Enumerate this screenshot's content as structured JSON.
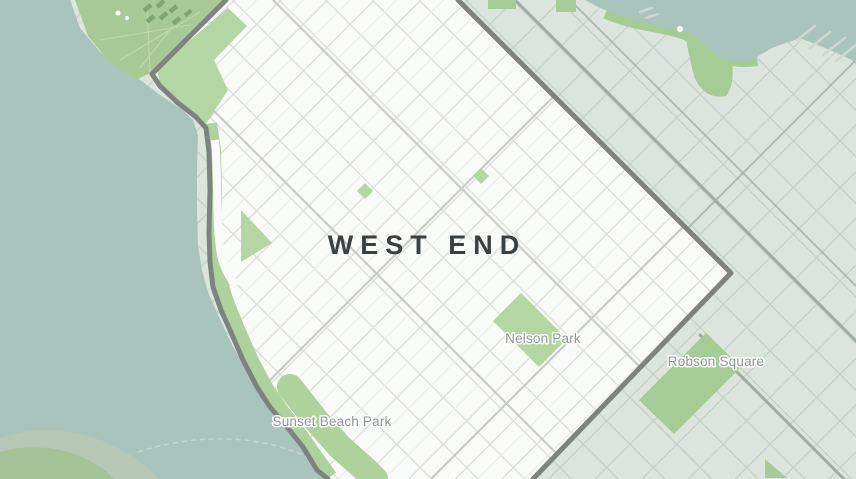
{
  "map": {
    "region_label": "WEST END",
    "place_labels": [
      {
        "name": "Nelson Park"
      },
      {
        "name": "Robson Square"
      },
      {
        "name": "Sunset Beach Park"
      }
    ]
  },
  "colors": {
    "water": "#a9c3bd",
    "shallow": "#b6c7b5",
    "swirl": "#a3c295",
    "pier": "#cdd8d1",
    "land": "#dbe5dd",
    "streetout": "#c2cfc6",
    "roadmajor": "#9dada4",
    "parkout": "#a6cc96",
    "stanley": "#a7c996",
    "stanleypath": "#c2daae",
    "footprint": "#7ea56e",
    "inner": "#f9fbf9",
    "streetin": "#d9dcd9",
    "lane": "#e9ebe9",
    "streetdark": "#c7ccc8",
    "bandgreen": "#aed29c",
    "parkin": "#b4d6a2",
    "boundary": "#7e8381",
    "regiontext": "#3a4143",
    "labelgray": "#8c9894"
  }
}
